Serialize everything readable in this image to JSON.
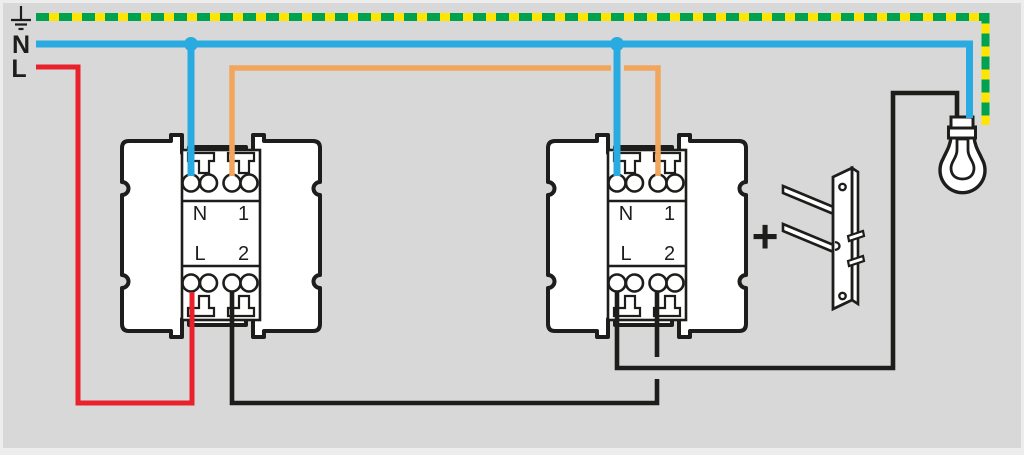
{
  "supply": {
    "neutral_label": "N",
    "line_label": "L"
  },
  "modules": [
    {
      "name": "switch-module-1",
      "labels": {
        "n": "N",
        "one": "1",
        "l": "L",
        "two": "2"
      }
    },
    {
      "name": "switch-module-2",
      "labels": {
        "n": "N",
        "one": "1",
        "l": "L",
        "two": "2"
      }
    }
  ],
  "accessory": {
    "plus_label": "+"
  },
  "colors": {
    "background": "#d8d8d8",
    "page_border": "#ededed",
    "earth_yellow": "#ffe500",
    "earth_green": "#00a24f",
    "neutral_blue": "#29abe2",
    "line_red": "#e8212b",
    "traveller_orange": "#f2a55c",
    "wire_black": "#1d1d1b",
    "device_fill": "#ffffff",
    "device_outline": "#1d1d1b"
  }
}
